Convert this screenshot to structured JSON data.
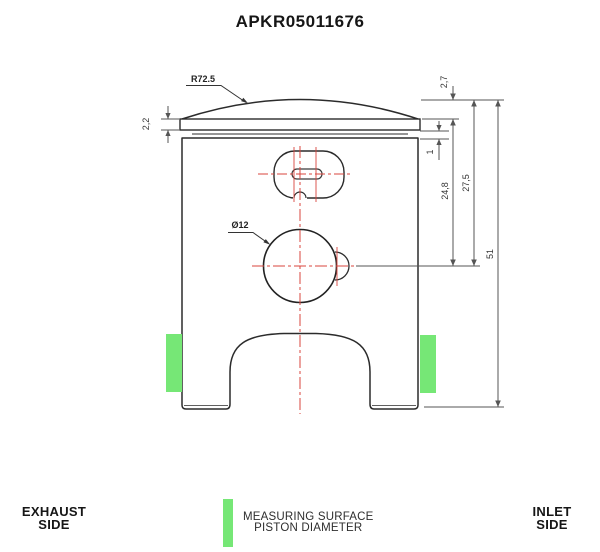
{
  "title": "APKR05011676",
  "dimensions": {
    "crown_radius": "R72.5",
    "dome_height": "2,7",
    "top_land_height": "2,2",
    "ring_groove_height": "1",
    "top_land_to_pin_center": "24,8",
    "crown_to_pin_center": "27,5",
    "total_height": "51",
    "pin_bore_diameter": "Ø12"
  },
  "legend": {
    "left_line1": "EXHAUST",
    "left_line2": "SIDE",
    "center_line1": "MEASURING SURFACE",
    "center_line2": "PISTON DIAMETER",
    "right_line1": "INLET",
    "right_line2": "SIDE"
  },
  "colors": {
    "measuring_surface_green": "#76e776",
    "centerline_red": "#d8453e"
  }
}
